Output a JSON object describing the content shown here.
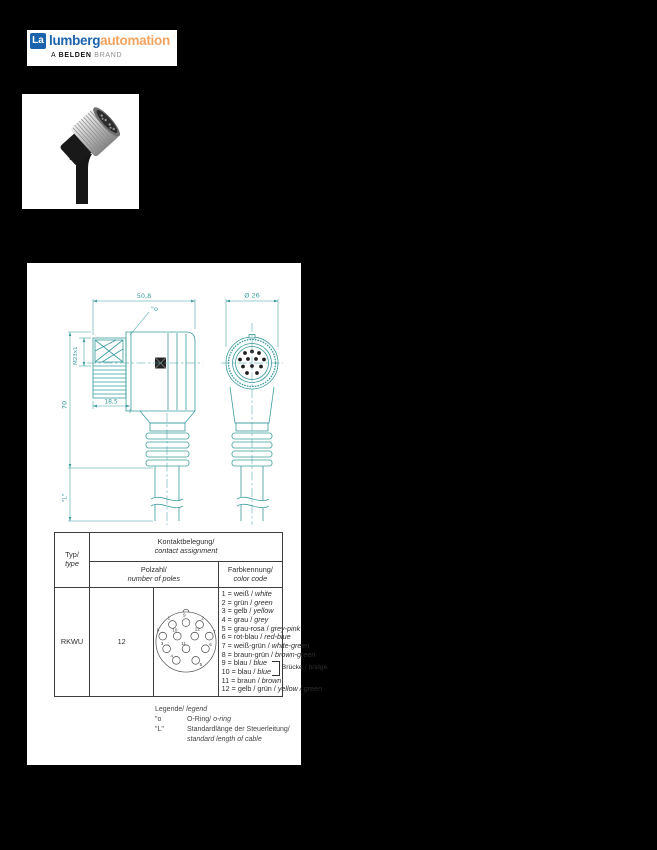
{
  "logo": {
    "mark": "La",
    "name_left": "lumberg",
    "name_right": "automation",
    "tagline_a": "A",
    "tagline_belden": "BELDEN",
    "tagline_brand": "BRAND",
    "colors": {
      "blue": "#1c63ad",
      "orange": "#f2a35f"
    }
  },
  "drawing": {
    "accent_color": "#3a9c9f",
    "dim_width": "50,8",
    "dim_height": "70",
    "dim_thread": "M23x1",
    "dim_nut_depth": "18,5",
    "dim_cable": "\"L\"",
    "oring_ref": "\"o",
    "dim_diameter": "Ø 26"
  },
  "table": {
    "col_type_de": "Typ/",
    "col_type_en": "type",
    "col_contact_de": "Kontaktbelegung/",
    "col_contact_en": "contact assignment",
    "col_poles_de": "Polzahl/",
    "col_poles_en": "number of poles",
    "col_color_de": "Farbkennung/",
    "col_color_en": "color code",
    "row": {
      "type": "RKWU",
      "poles": "12",
      "pin_labels": [
        "1",
        "9",
        "2",
        "8",
        "10",
        "12",
        "7",
        "3",
        "11",
        "6",
        "4",
        "5"
      ],
      "colors": [
        {
          "de": "1 = weiß / ",
          "en": "white"
        },
        {
          "de": "2 = grün / ",
          "en": "green"
        },
        {
          "de": "3 = gelb / ",
          "en": "yellow"
        },
        {
          "de": "4 = grau / ",
          "en": "grey"
        },
        {
          "de": "5 = grau-rosa / ",
          "en": "grey-pink"
        },
        {
          "de": "6 = rot-blau / ",
          "en": "red-blue"
        },
        {
          "de": "7 = weiß-grün / ",
          "en": "white-green"
        },
        {
          "de": "8 = braun-grün / ",
          "en": "brown-green"
        },
        {
          "de": "9 = blau / ",
          "en": "blue"
        },
        {
          "de": "10 = blau / ",
          "en": "blue"
        },
        {
          "de": "11 = braun / ",
          "en": "brown"
        },
        {
          "de": "12 = gelb / grün / ",
          "en": "yellow / green"
        }
      ],
      "bridge": "Brücke / bridge"
    }
  },
  "legend": {
    "title_de": "Legende/ ",
    "title_en": "legend",
    "item1_sym": "\"o",
    "item1_de": "O-Ring/ ",
    "item1_en": "o-ring",
    "item2_sym": "\"L\"",
    "item2_de": "Standardlänge der Steuerleitung/",
    "item2_en": "standard length of cable"
  }
}
